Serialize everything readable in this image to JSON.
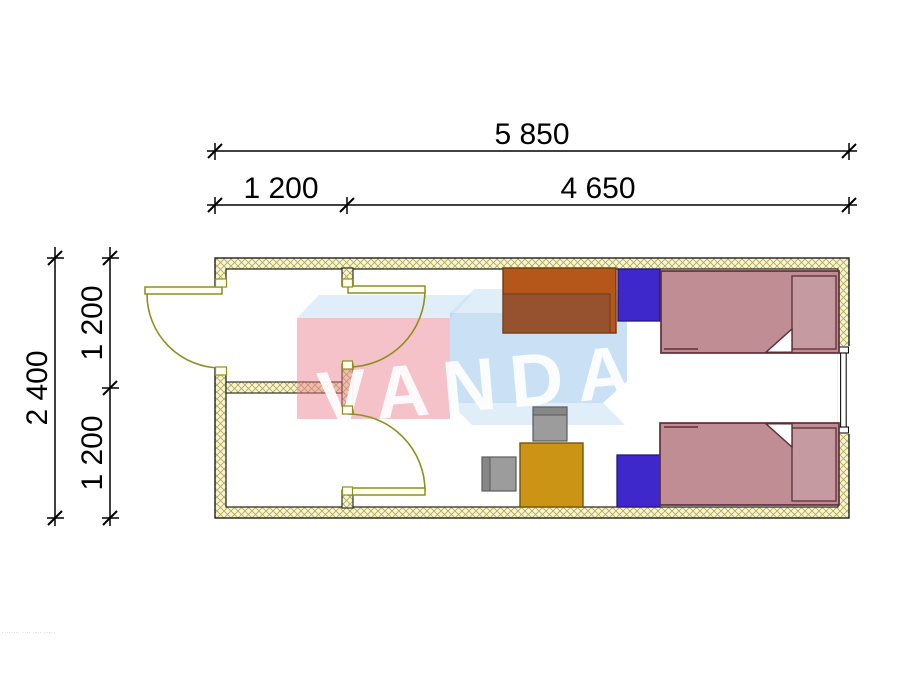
{
  "dimensions": {
    "top_total": "5 850",
    "top_segment_left": "1 200",
    "top_segment_right": "4 650",
    "side_total": "2 400",
    "side_upper": "1 200",
    "side_lower": "1 200"
  },
  "watermark": {
    "logo_text": "VANDA",
    "microtext": "········ ···· ·-·· ··-··"
  },
  "colors": {
    "wall_fill": "#f8f4da",
    "wall_hatch": "#b4ae4c",
    "wall_edge": "#1f1f1f",
    "door": "#8f8f1d",
    "door_leaf_fill": "#fffff2",
    "bed_fill": "#bf8d93",
    "bed_pillow": "#c59aa0",
    "bed_outline": "#5e2f37",
    "nightstand": "#3f28cb",
    "nightstand_outline": "#27177e",
    "table": "#cc9414",
    "table_outline": "#775608",
    "chair": "#9c9c9c",
    "chair_back": "#878787",
    "chair_outline": "#5a5a5a",
    "wardrobe": "#b5571a",
    "wardrobe_panel": "#96522e",
    "wardrobe_outline": "#6e3a12",
    "wm_pink": "rgba(232,120,135,0.45)",
    "wm_blue": "rgba(150,196,235,0.5)",
    "wm_blue_light": "rgba(193,222,246,0.5)",
    "dim_color": "#000000"
  },
  "plan_items": {
    "rooms": [
      "vestibule-upper",
      "vestibule-lower",
      "main-room"
    ],
    "openings": [
      "entrance-door",
      "interior-door-upper",
      "interior-door-lower",
      "window"
    ],
    "furniture": [
      "wardrobe",
      "nightstand-top",
      "bed-top",
      "nightstand-bottom",
      "bed-bottom",
      "table",
      "chair-top",
      "chair-left"
    ]
  }
}
